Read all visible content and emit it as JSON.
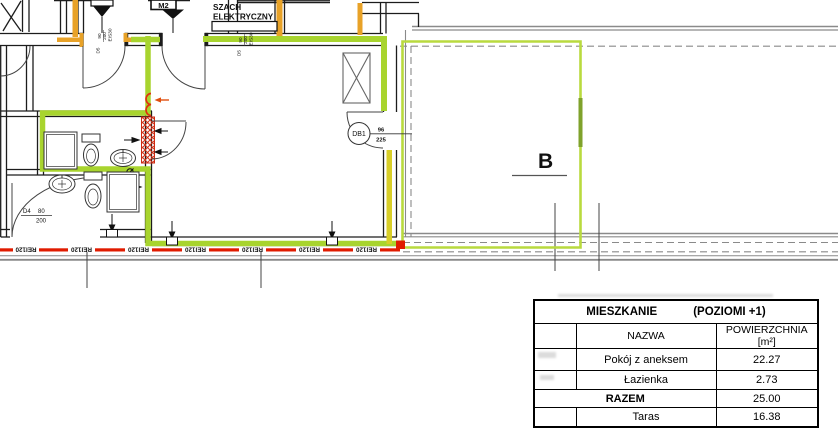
{
  "plan": {
    "shaft_label": {
      "line1": "SZACH",
      "line2": "ELEKTRYCZNY"
    },
    "riser_label": "M2",
    "balcony_door": {
      "id": "DB1",
      "width": "96",
      "height": "225"
    },
    "terrace_label": "B",
    "door_d4": {
      "id": "D4",
      "width": "80",
      "height": "200"
    },
    "door_d5_left": {
      "id": "D5",
      "width": "90",
      "height": "200",
      "rating": "EIS30"
    },
    "door_d5_right": {
      "id": "D5",
      "width": "90",
      "height": "200",
      "rating": "EIS30"
    },
    "fire_rating": "REI120",
    "colors": {
      "highlight_green": "#a8d42e",
      "terrace_green": "#b9da3e",
      "pipe_orange": "#e8a228",
      "beam_yellow": "#d8ce28",
      "fire_red": "#e01b00"
    }
  },
  "table": {
    "title": "MIESZKANIE",
    "subtitle": "(POZIOMI +1)",
    "columns": {
      "name": "NAZWA",
      "area": "POWIERZCHNIA [m²]"
    },
    "rows": [
      {
        "name": "Pokój z aneksem",
        "area": "22.27"
      },
      {
        "name": "Łazienka",
        "area": "2.73"
      }
    ],
    "total": {
      "label": "RAZEM",
      "value": "25.00"
    },
    "terrace": {
      "name": "Taras",
      "area": "16.38"
    }
  }
}
